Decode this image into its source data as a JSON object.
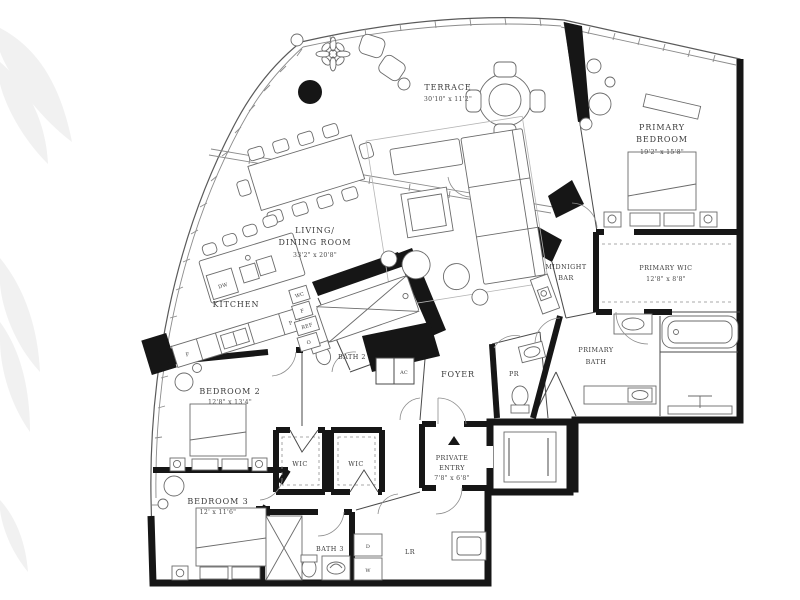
{
  "plan": {
    "rooms": {
      "terrace": {
        "name": "TERRACE",
        "dims": "30'10\" x 11'2\""
      },
      "primary_bedroom": {
        "line1": "PRIMARY",
        "line2": "BEDROOM",
        "dims": "19'2\" x 15'8\""
      },
      "living_dining": {
        "line1": "LIVING/",
        "line2": "DINING ROOM",
        "dims": "33'2\" x 20'8\""
      },
      "kitchen": {
        "name": "KITCHEN"
      },
      "midnight_bar": {
        "line1": "MIDNIGHT",
        "line2": "BAR"
      },
      "primary_wic": {
        "name": "PRIMARY WIC",
        "dims": "12'8\" x 8'8\""
      },
      "primary_bath": {
        "line1": "PRIMARY",
        "line2": "BATH"
      },
      "bath2": {
        "name": "BATH 2"
      },
      "foyer": {
        "name": "FOYER"
      },
      "powder_room": {
        "name": "PR"
      },
      "ac_closet": {
        "name": "AC"
      },
      "bedroom2": {
        "name": "BEDROOM 2",
        "dims": "12'8\" x 13'4\""
      },
      "bedroom3": {
        "name": "BEDROOM 3",
        "dims": "12' x 11'6\""
      },
      "wic_a": {
        "name": "WIC"
      },
      "wic_b": {
        "name": "WIC"
      },
      "private_entry": {
        "line1": "PRIVATE",
        "line2": "ENTRY",
        "dims": "7'8\" x 6'8\""
      },
      "bath3": {
        "name": "BATH 3"
      },
      "laundry": {
        "name": "LR"
      }
    },
    "appliances": {
      "dishwasher": "DW",
      "freezer": "F",
      "fridge": "REF",
      "oven": "O",
      "pantry": "P",
      "water_closet": "WC",
      "dryer": "D",
      "washer": "W"
    },
    "colors": {
      "wall": "#161616",
      "label": "#3b3b3b",
      "background": "#ffffff"
    }
  }
}
